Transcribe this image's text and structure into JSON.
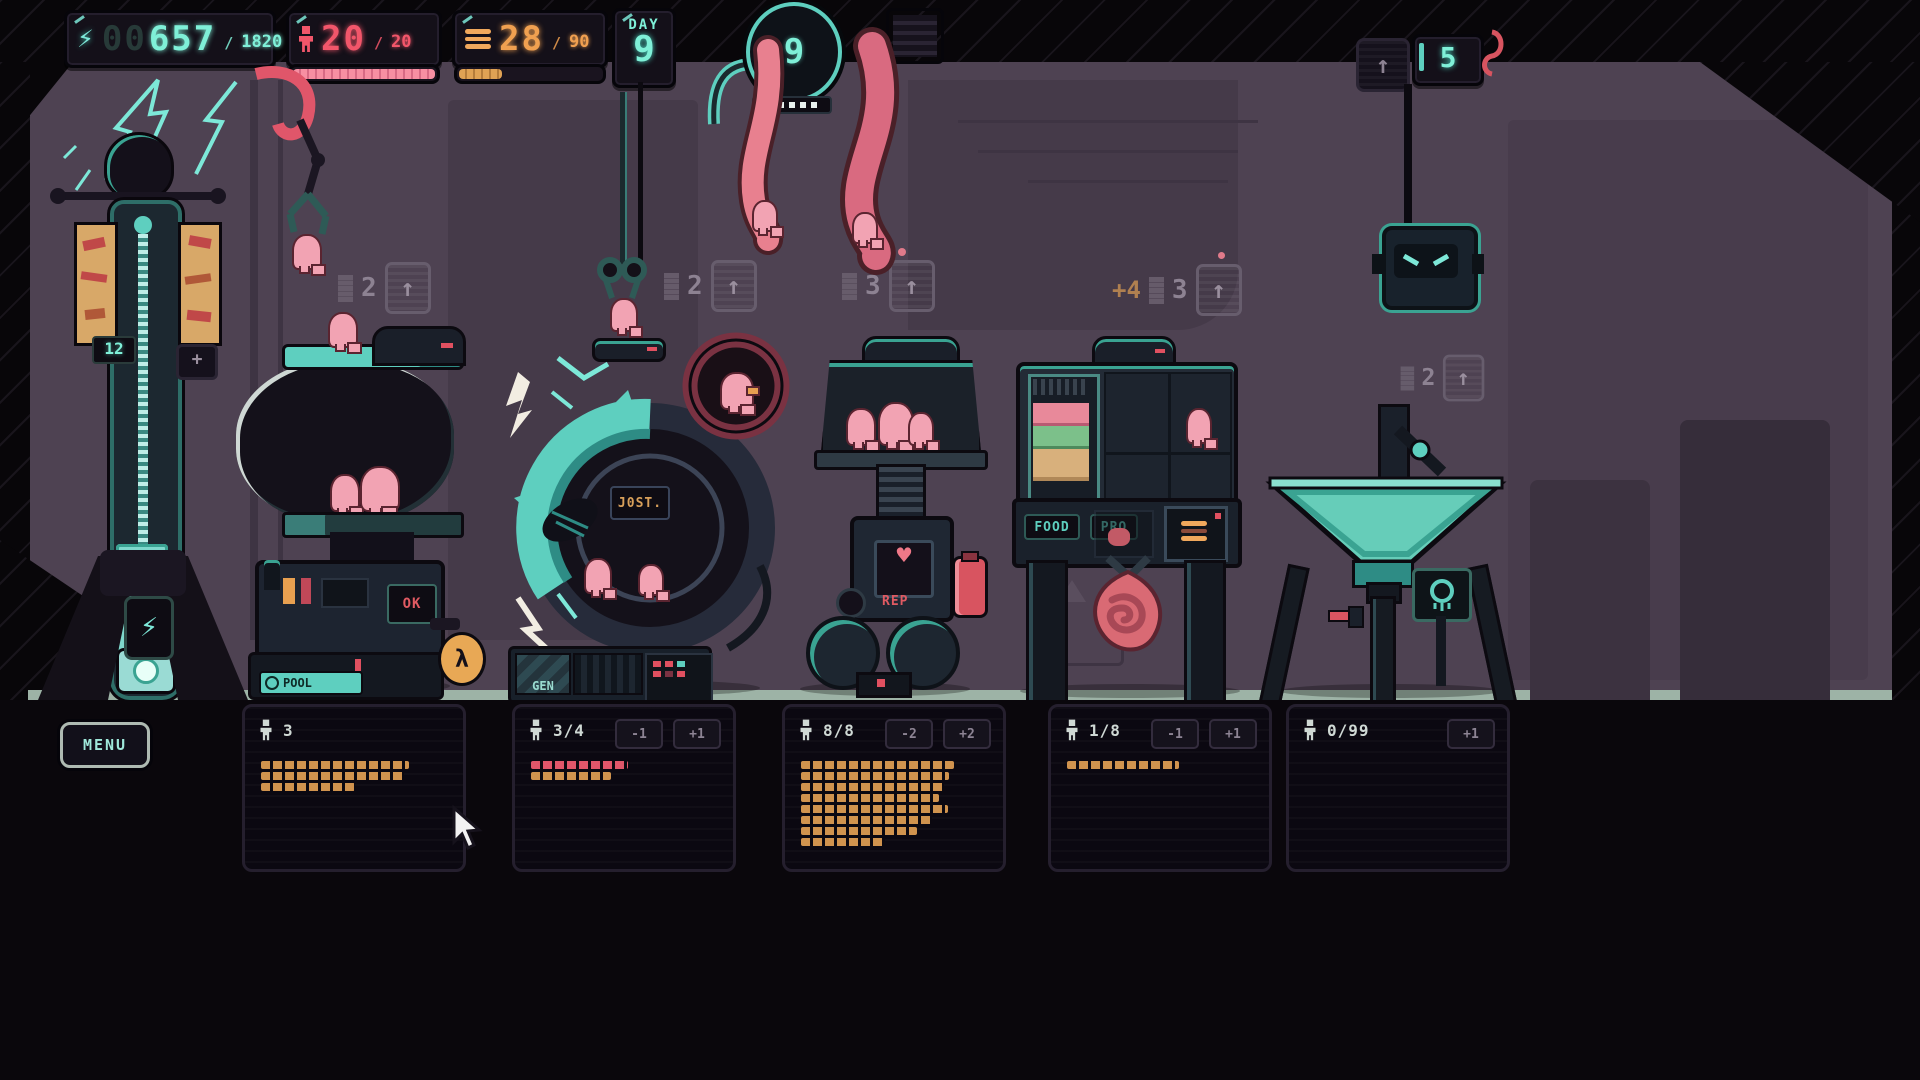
{
  "hud": {
    "energy": {
      "icon": "lightning-icon",
      "glyph": "⚡",
      "prefix": "00",
      "value": "657",
      "sep": "/",
      "max": "1820"
    },
    "population": {
      "icon": "person-icon",
      "value": "20",
      "sep": "/",
      "max": "20",
      "bar_fill_pct": 100
    },
    "food": {
      "icon": "burger-icon",
      "value": "28",
      "sep": "/",
      "max": "90",
      "bar_fill_pct": 30
    },
    "day": {
      "label": "DAY",
      "value": "9"
    },
    "core": {
      "value": "9",
      "pips_total": 5,
      "pips_lit": 5
    },
    "storage": {
      "up_glyph": "↑",
      "count": "5"
    }
  },
  "indicators": [
    {
      "value": "2",
      "up_glyph": "↑"
    },
    {
      "value": "2",
      "up_glyph": "↑"
    },
    {
      "value": "3",
      "up_glyph": "↑"
    },
    {
      "prefix": "+4",
      "value": "3",
      "up_glyph": "↑"
    },
    {
      "value": "2",
      "up_glyph": "↑"
    }
  ],
  "machines": {
    "tesla_tower": {
      "counter": "12",
      "plus_label": "+",
      "bolt_glyph": "⚡"
    },
    "incubator_pool": {
      "ok_label": "OK",
      "base_label": "POOL",
      "lambda_glyph": "λ"
    },
    "generator_wheel": {
      "badge": "J0ST.",
      "gen_label": "GEN"
    },
    "repair_press": {
      "label": "REP",
      "heart_glyph": "♥"
    },
    "food_processor": {
      "left_label": "FOOD",
      "right_label": "PRO"
    }
  },
  "bottom": {
    "menu_label": "MENU",
    "panels": [
      {
        "count": "3",
        "buttons": [],
        "bars": [
          {
            "width": 148,
            "color": "orange"
          },
          {
            "width": 143,
            "color": "orange"
          },
          {
            "width": 94,
            "color": "orange"
          }
        ]
      },
      {
        "count": "3/4",
        "buttons": [
          "-1",
          "+1"
        ],
        "bars": [
          {
            "width": 97,
            "color": "red"
          },
          {
            "width": 80,
            "color": "orange"
          }
        ]
      },
      {
        "count": "8/8",
        "buttons": [
          "-2",
          "+2"
        ],
        "bars": [
          {
            "width": 153,
            "color": "orange"
          },
          {
            "width": 148,
            "color": "orange"
          },
          {
            "width": 143,
            "color": "orange"
          },
          {
            "width": 138,
            "color": "orange"
          },
          {
            "width": 147,
            "color": "orange"
          },
          {
            "width": 131,
            "color": "orange"
          },
          {
            "width": 116,
            "color": "orange"
          },
          {
            "width": 84,
            "color": "orange"
          }
        ]
      },
      {
        "count": "1/8",
        "buttons": [
          "-1",
          "+1"
        ],
        "bars": [
          {
            "width": 112,
            "color": "orange"
          }
        ]
      },
      {
        "count": "0/99",
        "buttons": [
          "+1"
        ],
        "bars": []
      }
    ]
  },
  "colors": {
    "teal_accent": "#7ff0d8",
    "machine_teal": "#5ecfbf",
    "pop_red": "#f2566a",
    "food_orange": "#f0a050",
    "noob_pink": "#f2a3b3",
    "wall": "#4e4252",
    "bar_orange": "#d0934e",
    "bar_red": "#e0566a",
    "battery_red": "#d85460"
  }
}
